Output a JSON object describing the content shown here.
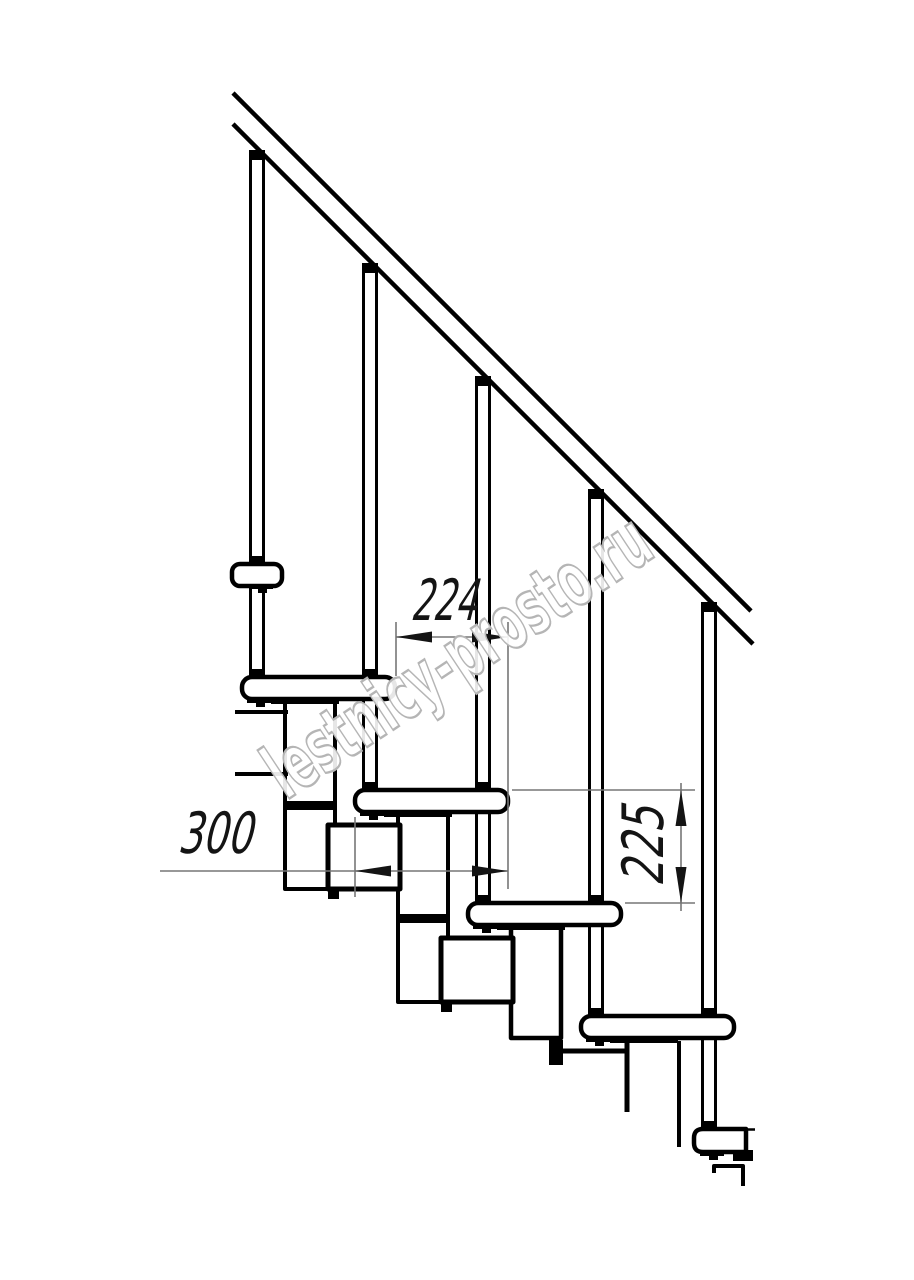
{
  "page": {
    "background": "#ffffff",
    "line_color": "#000000",
    "dimension_line_color": "#767676",
    "dimension_text_color": "#141414"
  },
  "watermark": {
    "text": "lestnicy-prosto.ru",
    "color": "#b5b5b5"
  },
  "dimensions": {
    "step_run": {
      "value": "224"
    },
    "tread_depth": {
      "value": "300"
    },
    "riser_height": {
      "value": "225"
    }
  }
}
